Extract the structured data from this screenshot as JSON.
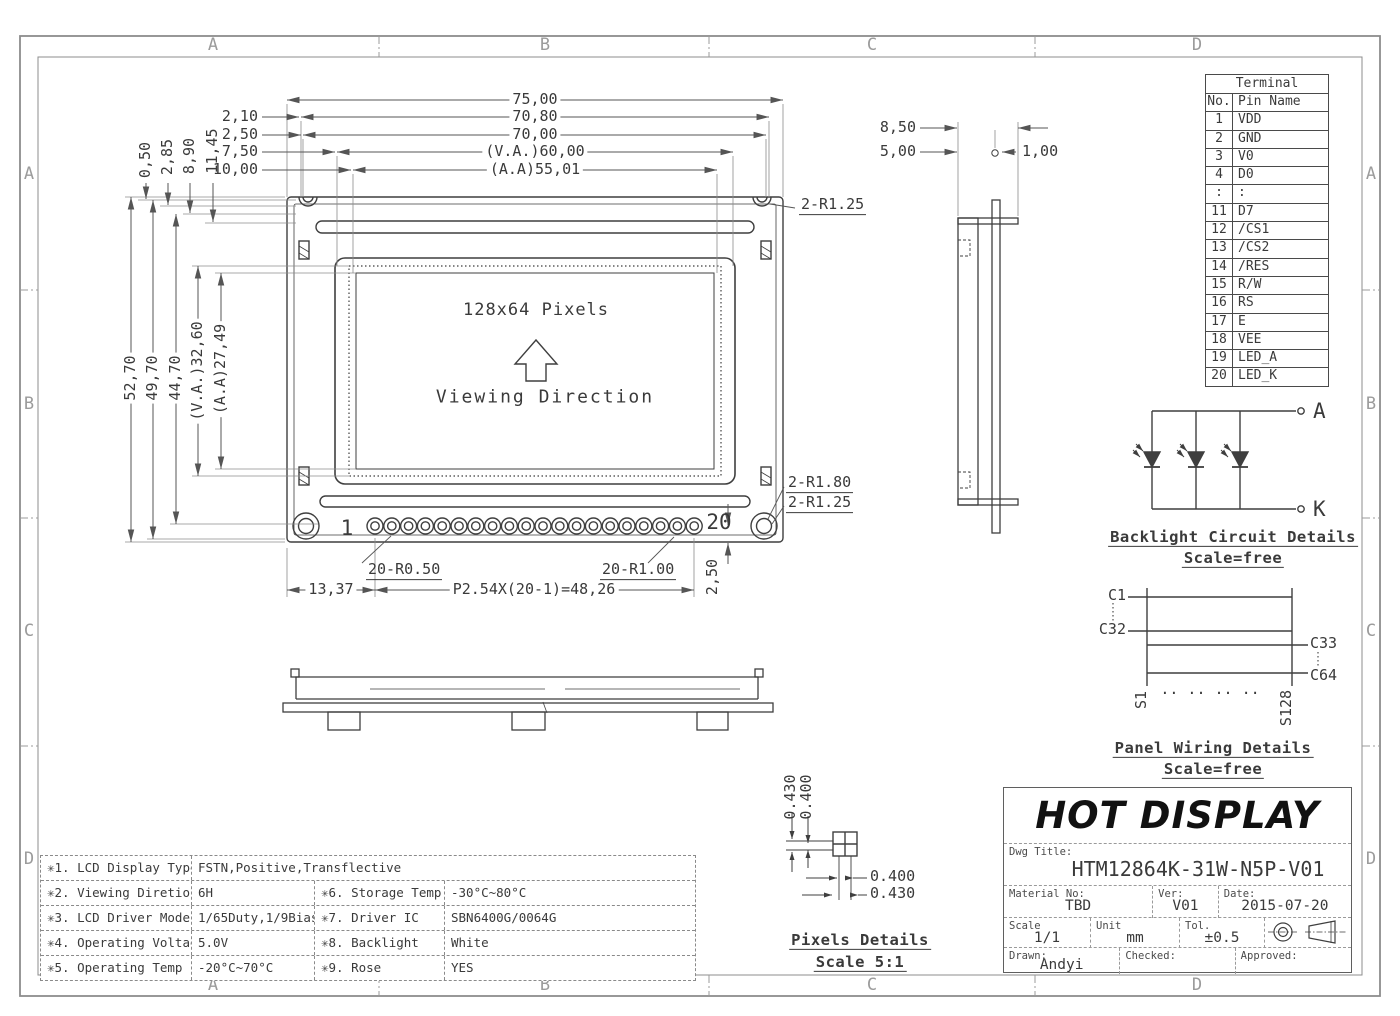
{
  "colors": {
    "line": "#3f3f3f",
    "dim": "#555555",
    "frame": "#8c8c8c",
    "zone_letter": "#9b9b9b",
    "background": "#ffffff"
  },
  "zones": {
    "z1": "A",
    "z2": "B",
    "z3": "C",
    "z4": "D"
  },
  "terminal": {
    "title": "Terminal",
    "col_no": "No.",
    "col_name": "Pin Name",
    "rows": [
      {
        "no": "1",
        "name": "VDD"
      },
      {
        "no": "2",
        "name": "GND"
      },
      {
        "no": "3",
        "name": "V0"
      },
      {
        "no": "4",
        "name": "D0"
      },
      {
        "no": ":",
        "name": ":"
      },
      {
        "no": "11",
        "name": "D7"
      },
      {
        "no": "12",
        "name": "/CS1"
      },
      {
        "no": "13",
        "name": "/CS2"
      },
      {
        "no": "14",
        "name": "/RES"
      },
      {
        "no": "15",
        "name": "R/W"
      },
      {
        "no": "16",
        "name": "RS"
      },
      {
        "no": "17",
        "name": "E"
      },
      {
        "no": "18",
        "name": "VEE"
      },
      {
        "no": "19",
        "name": "LED_A"
      },
      {
        "no": "20",
        "name": "LED_K"
      }
    ]
  },
  "front_view": {
    "pixels": "128x64 Pixels",
    "viewing": "Viewing Direction",
    "pin_first": "1",
    "pin_last": "20"
  },
  "dims": {
    "top": {
      "w75": "75,00",
      "w708": "70,80",
      "w70": "70,00",
      "va60": "(V.A.)60,00",
      "aa55": "(A.A)55,01",
      "s210": "2,10",
      "s250": "2,50",
      "s750": "7,50",
      "s1000": "10,00"
    },
    "left_small": {
      "v050": "0,50",
      "v285": "2,85",
      "v890": "8,90",
      "v1145": "11,45"
    },
    "left": {
      "h527": "52,70",
      "h497": "49,70",
      "h447": "44,70",
      "va326": "(V.A.)32,60",
      "aa2749": "(A.A)27,49"
    },
    "bottom": {
      "d1337": "13,37",
      "pitch": "P2.54X(20-1)=48,26",
      "d250": "2,50",
      "r050": "20-R0.50",
      "r100": "20-R1.00"
    },
    "radii": {
      "top_r125": "2-R1.25",
      "r180": "2-R1.80",
      "r125": "2-R1.25"
    },
    "side": {
      "t850": "8,50",
      "t500": "5,00",
      "t100": "1,00"
    }
  },
  "backlight": {
    "a": "A",
    "k": "K",
    "title": "Backlight Circuit Details",
    "scale": "Scale=free"
  },
  "panel": {
    "c1": "C1",
    "c32": "C32",
    "c33": "C33",
    "c64": "C64",
    "s1": "S1",
    "s128": "S128",
    "dots": ".. .. .. ..",
    "title": "Panel Wiring Details",
    "scale": "Scale=free"
  },
  "pixels_detail": {
    "v430": "0.430",
    "v400": "0.400",
    "h400": "0.400",
    "h430": "0.430",
    "title": "Pixels Details",
    "scale": "Scale 5:1"
  },
  "specs": {
    "rows": [
      {
        "c0": "✳1. LCD Display Type",
        "c1": "FSTN,Positive,Transflective"
      },
      {
        "c0": "✳2. Viewing Diretion",
        "c1": "6H",
        "c2": "✳6. Storage Temp",
        "c3": "-30°C~80°C"
      },
      {
        "c0": "✳3. LCD Driver Mode",
        "c1": "1/65Duty,1/9Bias",
        "c2": "✳7. Driver IC",
        "c3": "SBN6400G/0064G"
      },
      {
        "c0": "✳4. Operating Voltage",
        "c1": "5.0V",
        "c2": "✳8. Backlight",
        "c3": "White"
      },
      {
        "c0": "✳5. Operating Temp",
        "c1": "-20°C~70°C",
        "c2": "✳9. Rose",
        "c3": "YES"
      }
    ]
  },
  "title_block": {
    "company": "HOT DISPLAY",
    "dwg_title_label": "Dwg Title:",
    "dwg_title": "HTM12864K-31W-N5P-V01",
    "material_label": "Material No:",
    "material": "TBD",
    "ver_label": "Ver:",
    "ver": "V01",
    "date_label": "Date:",
    "date": "2015-07-20",
    "scale_label": "Scale",
    "scale": "1/1",
    "unit_label": "Unit",
    "unit": "mm",
    "tol_label": "Tol.",
    "tol": "±0.5",
    "drawn_label": "Drawn:",
    "drawn": "Andyi",
    "checked_label": "Checked:",
    "approved_label": "Approved:"
  }
}
